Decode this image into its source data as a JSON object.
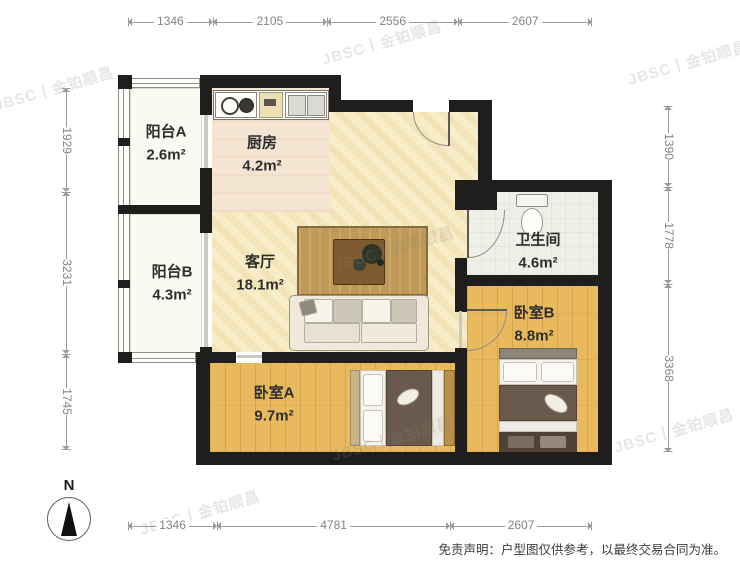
{
  "watermark": {
    "text": "JBSC丨金铂顺昌"
  },
  "rooms": {
    "balcony_a": {
      "name": "阳台A",
      "area": "2.6m²"
    },
    "kitchen": {
      "name": "厨房",
      "area": "4.2m²"
    },
    "balcony_b": {
      "name": "阳台B",
      "area": "4.3m²"
    },
    "living": {
      "name": "客厅",
      "area": "18.1m²"
    },
    "bathroom": {
      "name": "卫生间",
      "area": "4.6m²"
    },
    "bedroom_b": {
      "name": "卧室B",
      "area": "8.8m²"
    },
    "bedroom_a": {
      "name": "卧室A",
      "area": "9.7m²"
    }
  },
  "dimensions": {
    "top": [
      1346,
      2105,
      2556,
      2607
    ],
    "bottom": [
      1346,
      4781,
      2607
    ],
    "left": [
      1929,
      3231,
      1745
    ],
    "right": [
      1390,
      1778,
      3368
    ]
  },
  "compass": {
    "label": "N"
  },
  "disclaimer": "免责声明：户型图仅供参考，以最终交易合同为准。",
  "colors": {
    "wall": "#1f1e1c",
    "wood_floor": "#e8ba5d",
    "living_floor": "#f8edc9",
    "dim_line": "#9b9b9b"
  }
}
